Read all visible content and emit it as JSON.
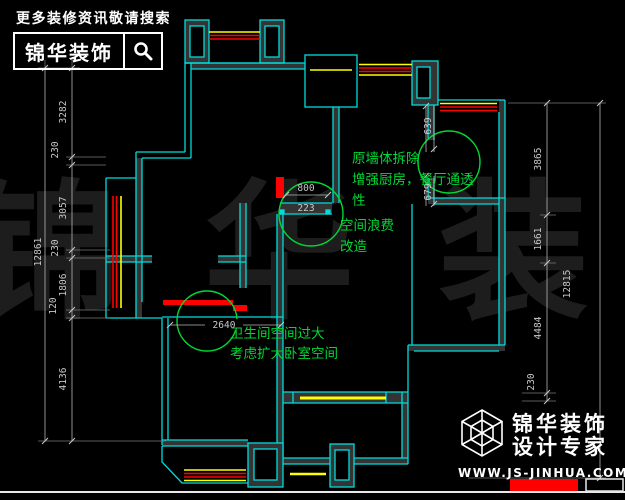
{
  "header_logo": {
    "tagline": "更多装修资讯敬请搜索",
    "brand": "锦华装饰",
    "search_icon": "magnifier"
  },
  "watermark_text": "锦 华 装 饰",
  "footer_logo": {
    "brand_line1": "锦华装饰",
    "brand_line2": "设计专家",
    "website": "WWW.JS-JINHUA.COM",
    "cube_icon": "wireframe-cube"
  },
  "annotations": {
    "kitchen_note": {
      "line1": "原墙体拆除",
      "line2": "增强厨房，餐厅通透",
      "line3": "性"
    },
    "waste_note": {
      "line1": "空间浪费",
      "line2": "改造"
    },
    "bath_note": {
      "line1": "卫生间空间过大",
      "line2": "考虑扩大卧室空间"
    }
  },
  "dimensions": {
    "left_chain": [
      "3282",
      "230",
      "3057",
      "230",
      "1806",
      "120",
      "4136"
    ],
    "left_total": "12861",
    "right_chain": [
      "3865",
      "1661",
      "4484",
      "230"
    ],
    "right_total": "12815",
    "door_width": "800",
    "door_return": "223",
    "opening_upper": "639",
    "opening_lower": "679",
    "bath_wall": "2640"
  },
  "colors": {
    "wall": "#00dcdc",
    "wall_fill": "#343434",
    "removed_wall": "#ff0000",
    "window": "#ffff00",
    "window_red": "#ff0000",
    "annotation_green": "#00d935",
    "dimension_text": "#c8c8c8",
    "watermark": "#1d1d1d"
  }
}
